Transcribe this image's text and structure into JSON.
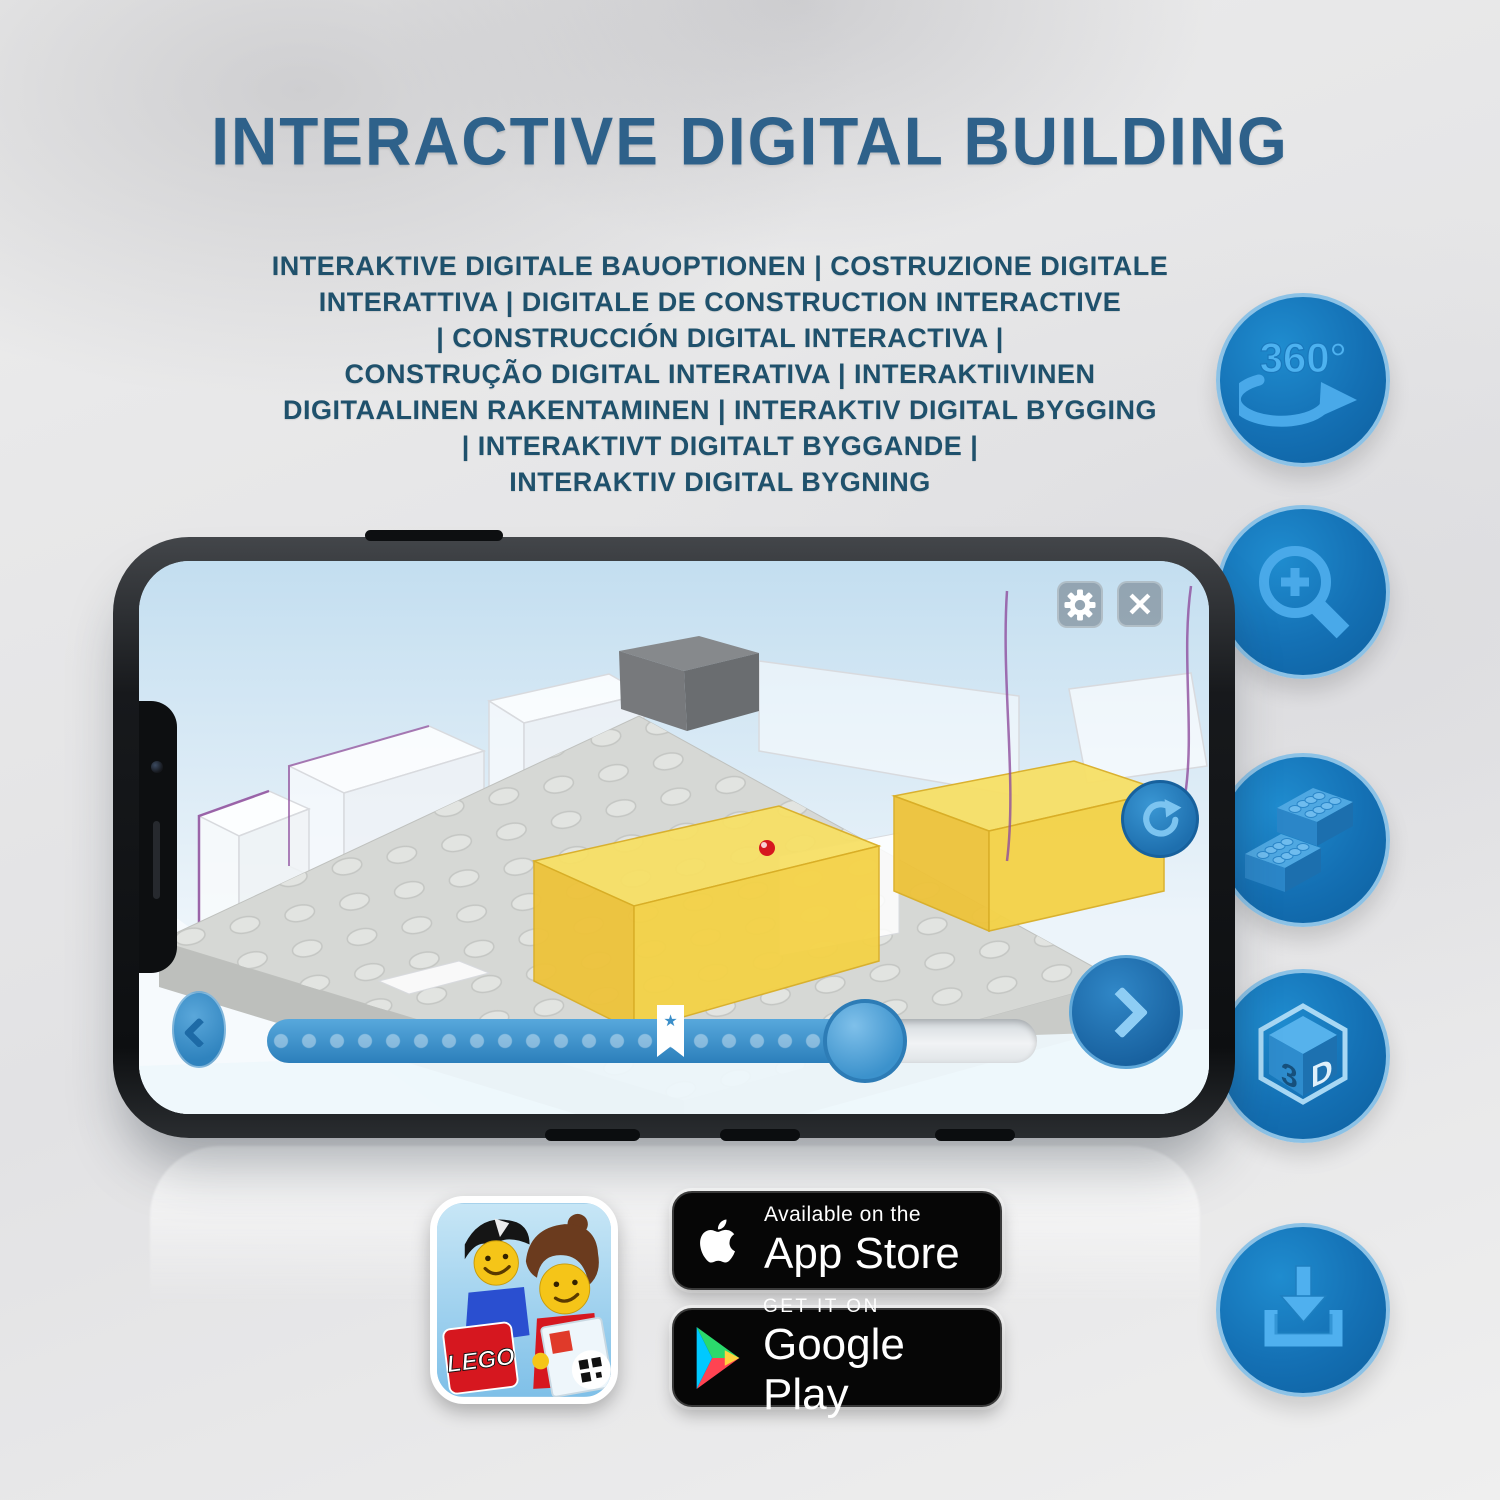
{
  "title": "INTERACTIVE DIGITAL BUILDING",
  "subtitle": {
    "lines": [
      "INTERAKTIVE DIGITALE BAUOPTIONEN | COSTRUZIONE DIGITALE",
      "INTERATTIVA | DIGITALE DE CONSTRUCTION INTERACTIVE",
      "| CONSTRUCCIÓN DIGITAL INTERACTIVA |",
      "CONSTRUÇÃO DIGITAL INTERATIVA | INTERAKTIIVINEN",
      "DIGITAALINEN RAKENTAMINEN | INTERAKTIV DIGITAL BYGGING",
      "| INTERAKTIVT DIGITALT BYGGANDE |",
      "INTERAKTIV DIGITAL BYGNING"
    ]
  },
  "feature_icons": [
    {
      "name": "360-rotation",
      "label": "360°"
    },
    {
      "name": "zoom-in-magnifier"
    },
    {
      "name": "lego-bricks"
    },
    {
      "name": "3d-cube",
      "face_left": "3",
      "face_right": "D"
    },
    {
      "name": "download"
    }
  ],
  "phone": {
    "app_ui": {
      "settings_icon": "gear",
      "close_icon": "✕",
      "rotate_icon": "circular-arrow",
      "prev_icon": "chevron-left",
      "next_icon": "chevron-right",
      "slider_star": "★"
    }
  },
  "badges": {
    "lego_app": {
      "logo": "LEGO"
    },
    "app_store": {
      "tagline": "Available on the",
      "store": "App Store"
    },
    "google_play": {
      "tagline": "GET IT ON",
      "store": "Google Play"
    }
  },
  "colors": {
    "accent_blue": "#1878be",
    "icon_light_blue": "#49a9e9",
    "circle_border": "#8cc2e6",
    "title_blue": "#2e618a",
    "subtitle_blue": "#1f516c",
    "badge_black": "#060606",
    "lego_red": "#d6171f",
    "brick_yellow": "#f2cf3e"
  }
}
